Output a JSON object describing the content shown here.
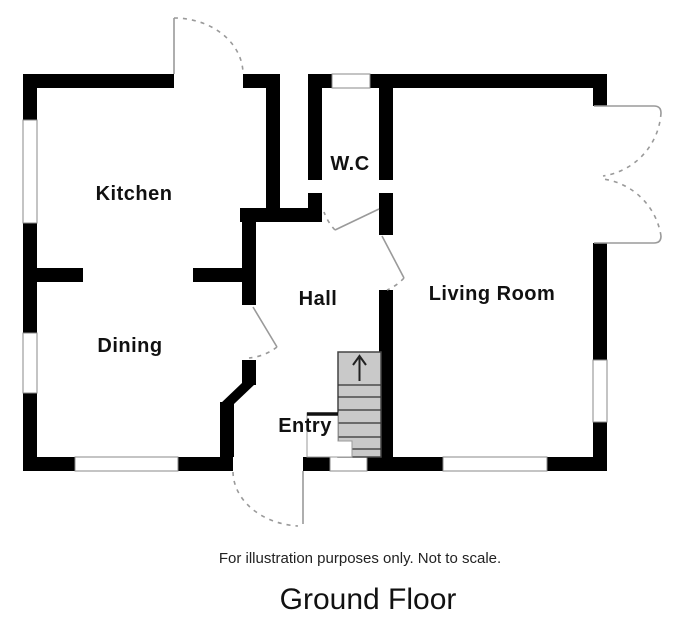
{
  "plan": {
    "rooms": {
      "kitchen": {
        "label": "Kitchen"
      },
      "dining": {
        "label": "Dining"
      },
      "wc": {
        "label": "W.C"
      },
      "hall": {
        "label": "Hall"
      },
      "entry": {
        "label": "Entry"
      },
      "living_room": {
        "label": "Living Room"
      }
    },
    "stairs": {
      "icon": "arrow-up-icon",
      "direction": "up"
    },
    "disclaimer": "For illustration purposes only. Not to scale.",
    "title": "Ground Floor",
    "colors": {
      "wall": "#000000",
      "door_line": "#9a9a9a",
      "window_border": "#8a8a8a",
      "stair_fill": "#c9c9c9",
      "text": "#111111",
      "background": "#ffffff"
    }
  }
}
